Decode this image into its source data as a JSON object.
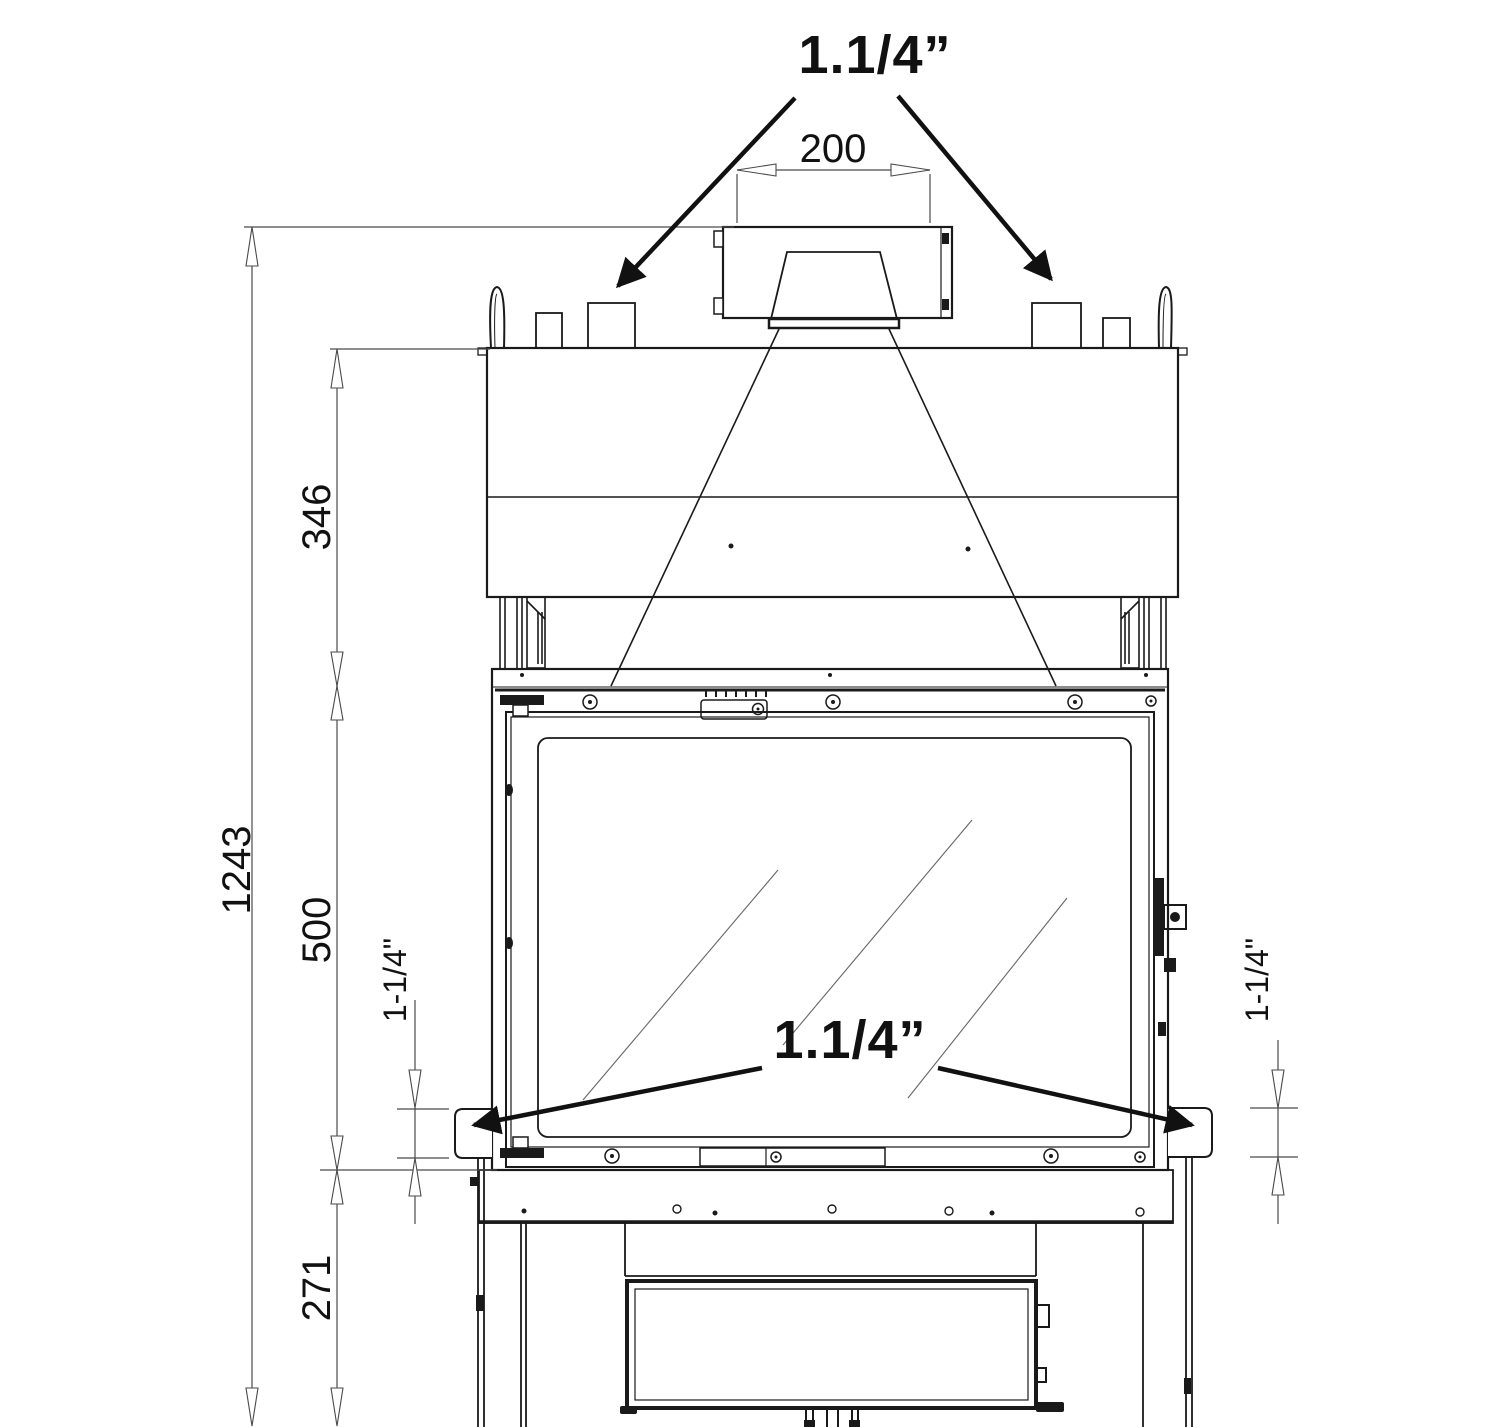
{
  "drawing": {
    "type": "fireplace-insert-front-elevation-technical-drawing",
    "labels": {
      "top_connection": "1.1/4”",
      "flue_width_mm": "200",
      "total_height_mm": "1243",
      "hood_height_mm": "346",
      "door_height_mm": "500",
      "base_height_mm": "271",
      "left_connection": "1-1/4\"",
      "right_connection": "1-1/4\"",
      "side_connection": "1.1/4”"
    },
    "colors": {
      "line": "#1a1a1a",
      "dimension": "#4a4a4a",
      "background": "#ffffff"
    }
  }
}
